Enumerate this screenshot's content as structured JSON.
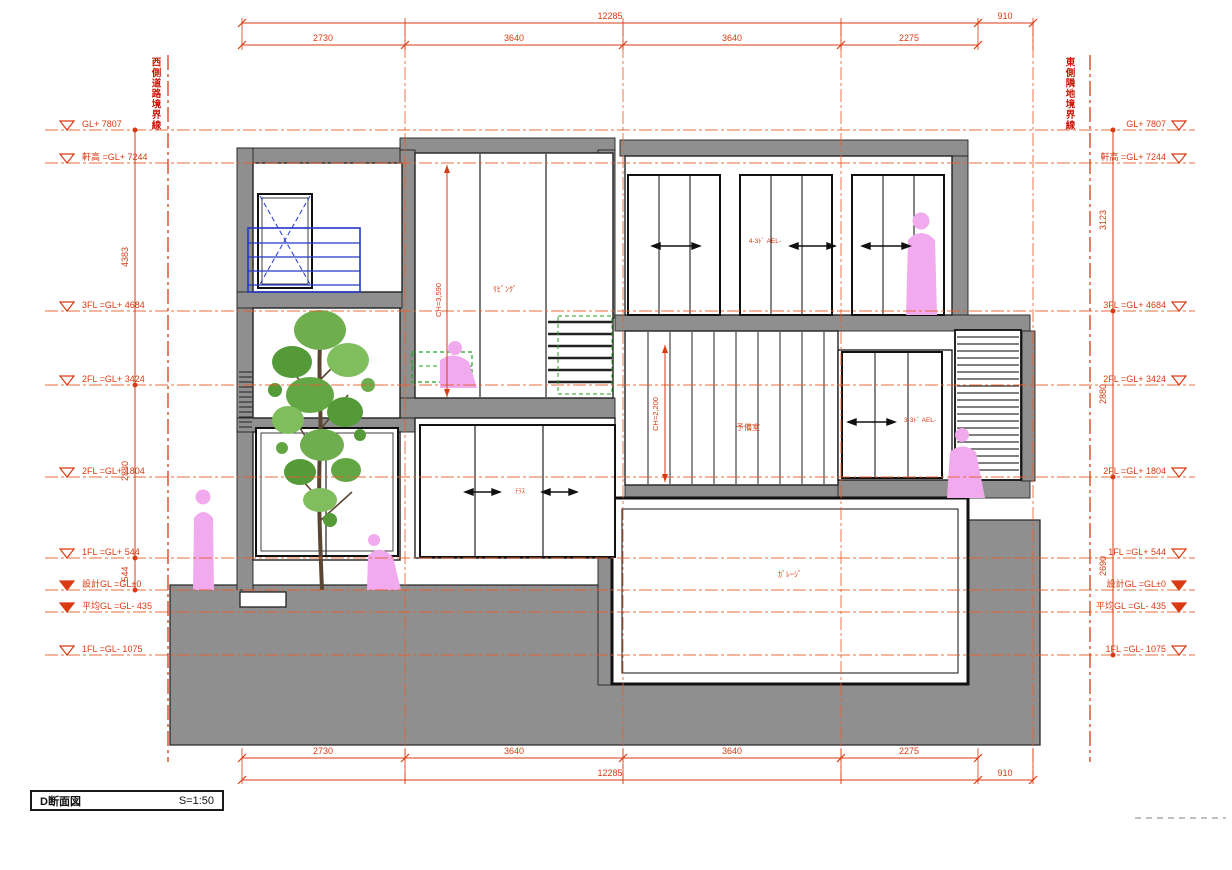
{
  "title_block": {
    "title": "D断面図",
    "scale": "S=1:50"
  },
  "boundary_labels": {
    "left": "西側道路境界線",
    "right": "東側隣地境界線"
  },
  "dimensions": {
    "top_overall": "12285",
    "top_segments": [
      "2730",
      "3640",
      "3640",
      "2275"
    ],
    "top_right": "910",
    "bottom_overall": "12285",
    "bottom_segments": [
      "2730",
      "3640",
      "3640",
      "2275"
    ],
    "bottom_right": "910",
    "left_chain": [
      "4383",
      "2880",
      "544"
    ],
    "right_chain": [
      "3123",
      "2880",
      "2690"
    ]
  },
  "levels": [
    {
      "label": "GL+ 7807",
      "marker": "open"
    },
    {
      "label": "軒高 =GL+ 7244",
      "marker": "open"
    },
    {
      "label": "3FL =GL+ 4684",
      "marker": "open"
    },
    {
      "label": "2FL =GL+ 3424",
      "marker": "open"
    },
    {
      "label": "2FL =GL+ 1804",
      "marker": "open"
    },
    {
      "label": "1FL =GL+ 544",
      "marker": "open"
    },
    {
      "label": "設計GL =GL±0",
      "marker": "filled"
    },
    {
      "label": "平均GL =GL- 435",
      "marker": "filled"
    },
    {
      "label": "1FL =GL- 1075",
      "marker": "open"
    }
  ],
  "annotations": {
    "ch_living": "CH=3,590",
    "ch_spare": "CH=2,200",
    "room_living": "ﾘﾋﾞﾝｸﾞ",
    "room_spare": "予備室",
    "room_garage": "ｶﾞﾚｰｼﾞ",
    "window_3f": "4-3ﾄﾞ AEL-",
    "window_2f": "3-3ﾄﾞ AEL-",
    "window_1f": "ﾃﾗｽ"
  },
  "colors": {
    "dim_red": "#d93a12",
    "line_red": "#e6602f",
    "poche_gray": "#8f8f8f",
    "rail_blue": "#2238c8",
    "furniture_green": "#22a322",
    "figure_pink": "#f2aaee"
  }
}
